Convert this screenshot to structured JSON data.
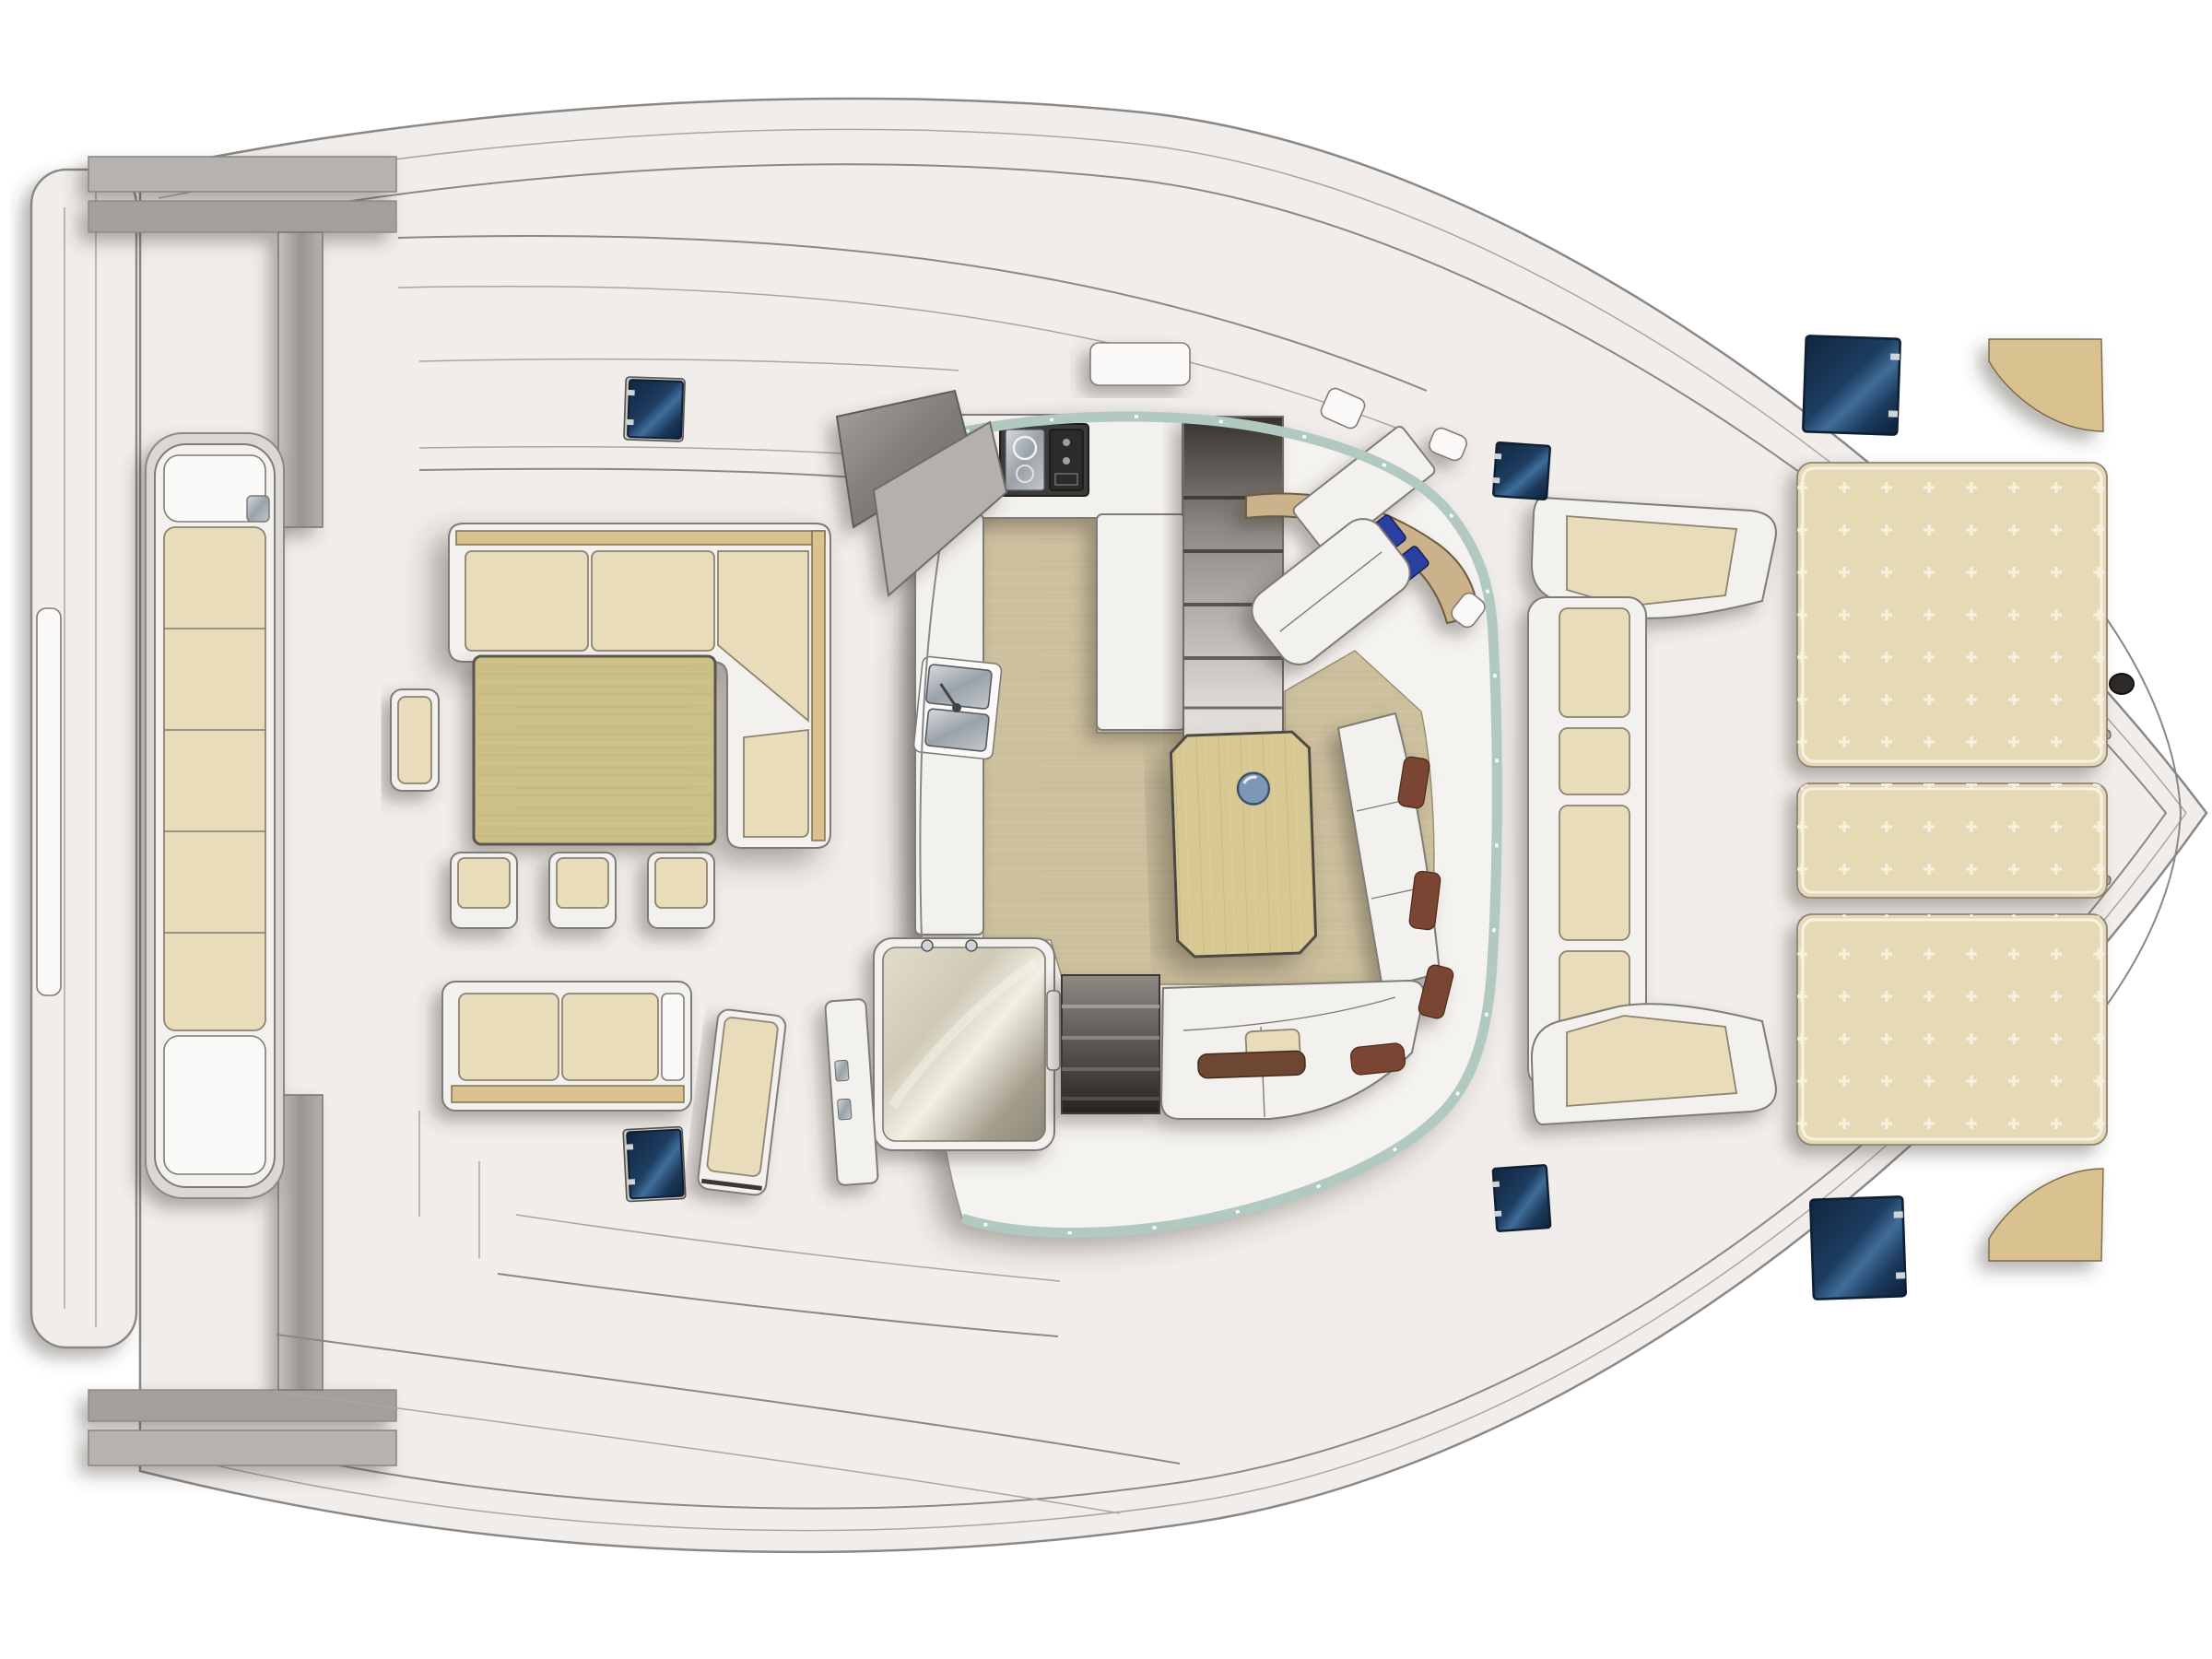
{
  "page": {
    "background": "#ffffff",
    "kind": "catamaran-main-deck-floorplan",
    "orientation": "bow-right"
  },
  "palette": {
    "page_bg": "#ffffff",
    "deck": "#f1edea",
    "cabin_floor_white": "#f5f3f0",
    "hull_line": "#8a8886",
    "inner_line": "#a8a5a2",
    "white_furniture": "#f3f1ee",
    "white_bright": "#fbfaf8",
    "furniture_line": "#7f7c78",
    "cushion": "#e9dcba",
    "cushion_line": "#8d8372",
    "sunpad": "#e6dab6",
    "sunpad_dot": "#f8f3e4",
    "wood_table": "#ccbf86",
    "wood_floor": "#cdc09e",
    "wood_grain": "#bfb190",
    "coffee_table": "#d8c893",
    "wood_trim": "#d9c28f",
    "nav_desk_wood": "#cbb28a",
    "hatch_dark": "#12283f",
    "hatch_mid": "#2e5a85",
    "hatch_light": "#4a7aa6",
    "glass": "#b2c9c1",
    "steel_light": "#c9cdd1",
    "steel_dark": "#8e949a",
    "gray_structure": "#b6b3af",
    "gray_structure2": "#a39f9b",
    "dark_stairs": "#55514c",
    "nav_cushion": "#2a3f9e",
    "bolster_brown": "#7a4530",
    "stove_dark": "#3c3b39",
    "shadow": "#3d3832"
  },
  "inventory": {
    "deck_hatches": 6,
    "bar_stools": 3,
    "sunpad_sections": 3,
    "transom_bench_cushions": 5,
    "foredeck_bench_cushions": 6,
    "dining_sofa_back_cushions": 3,
    "aft_sofa_cushions": 2,
    "nav_seat_cushions": 2,
    "settee_pillows": 3,
    "window_bolsters": 3,
    "stove_burners": 2,
    "sink_basins": 2,
    "stair_flights": 2
  },
  "regions": {
    "stern": [
      "swim-platform",
      "davit-beams",
      "transom-bench"
    ],
    "cockpit": [
      "dining-l-sofa",
      "dining-table",
      "bar-stools",
      "end-seat",
      "aft-sofa",
      "lounger-panel",
      "sliding-door"
    ],
    "saloon": [
      "wood-floor",
      "coffee-table",
      "settee",
      "nav-station",
      "companionway-port",
      "companionway-starboard",
      "wet-room"
    ],
    "galley": [
      "u-counter",
      "stove",
      "double-sink"
    ],
    "foredeck": [
      "c-bench",
      "sunpads",
      "corner-wedge-pads",
      "bow-fitting"
    ]
  }
}
